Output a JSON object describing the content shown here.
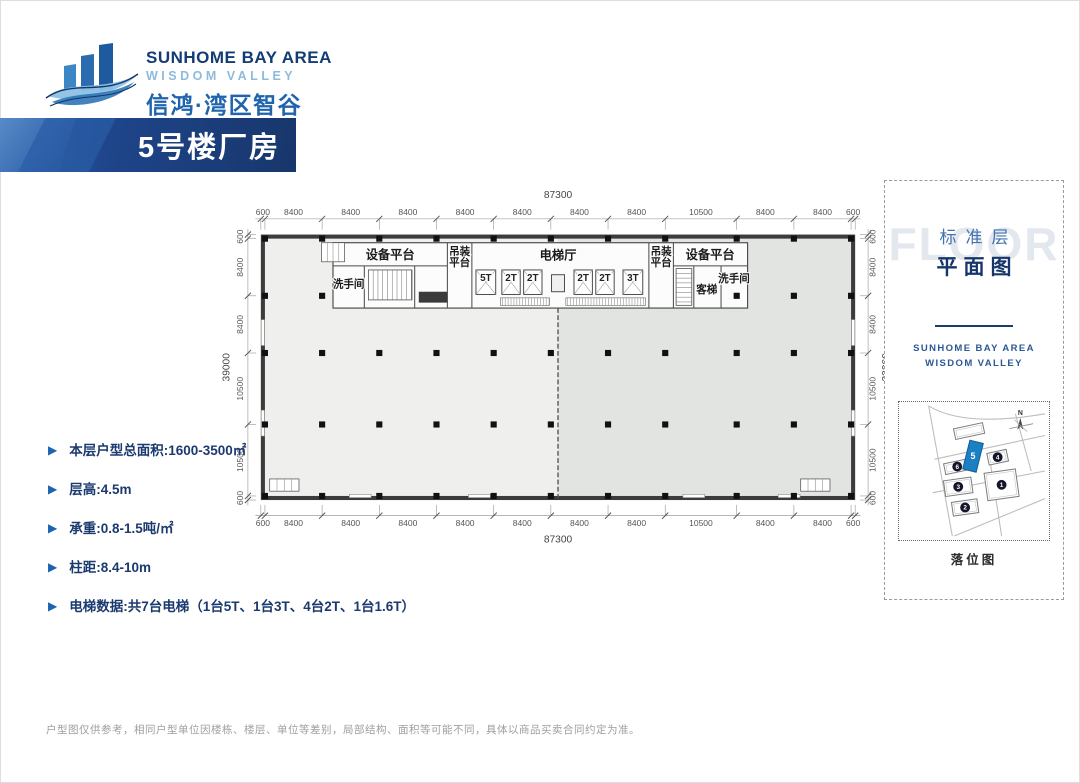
{
  "logo": {
    "line1": "SUNHOME BAY AREA",
    "line2": "WISDOM VALLEY",
    "line3": "信鸿·湾区智谷"
  },
  "banner": {
    "title": "5号楼厂房"
  },
  "specs": [
    "本层户型总面积:1600-3500㎡",
    "层高:4.5m",
    "承重:0.8-1.5吨/㎡",
    "柱距:8.4-10m",
    "电梯数据:共7台电梯（1台5T、1台3T、4台2T、1台1.6T）"
  ],
  "plan": {
    "total_width_label": "87300",
    "total_height_label": "39000",
    "h_segments": [
      600,
      8400,
      8400,
      8400,
      8400,
      8400,
      8400,
      8400,
      10500,
      8400,
      8400,
      600
    ],
    "v_segments": [
      600,
      8400,
      8400,
      10500,
      10500,
      600
    ],
    "partial_row_y": 9000,
    "partial_row_xs": [
      600,
      9000,
      69900,
      78300,
      86700
    ],
    "unit_fill_left": "#efefee",
    "unit_fill_right": "#e2e4e1",
    "core": {
      "x1": 10600,
      "x2": 71500,
      "y1": 1200,
      "y2": 10800
    },
    "core_walls_v": [
      [
        27400,
        1200,
        10800
      ],
      [
        31000,
        1200,
        10800
      ],
      [
        57000,
        1200,
        10800
      ],
      [
        60600,
        1200,
        10800
      ],
      [
        15200,
        4600,
        10800
      ],
      [
        22600,
        4600,
        10800
      ],
      [
        63600,
        4600,
        10800
      ],
      [
        67600,
        4600,
        10800
      ]
    ],
    "core_walls_h": [
      [
        10600,
        27400,
        4600
      ],
      [
        60600,
        71500,
        4600
      ]
    ],
    "room_labels": [
      {
        "t": "设备平台",
        "x": 19000,
        "y": 3600,
        "fs": 1800
      },
      {
        "t": "设备平台",
        "x": 66000,
        "y": 3600,
        "fs": 1800
      },
      {
        "t": "吊装",
        "x": 29200,
        "y": 3000,
        "fs": 1550
      },
      {
        "t": "平台",
        "x": 29200,
        "y": 4650,
        "fs": 1550
      },
      {
        "t": "吊装",
        "x": 58800,
        "y": 3000,
        "fs": 1550
      },
      {
        "t": "平台",
        "x": 58800,
        "y": 4650,
        "fs": 1550
      },
      {
        "t": "电梯厅",
        "x": 43650,
        "y": 3700,
        "fs": 1800
      },
      {
        "t": "洗手间",
        "x": 12900,
        "y": 7800,
        "fs": 1550
      },
      {
        "t": "洗手间",
        "x": 69500,
        "y": 7000,
        "fs": 1550
      },
      {
        "t": "客梯",
        "x": 65500,
        "y": 8600,
        "fs": 1550
      }
    ],
    "elevators": [
      {
        "label": "5T",
        "x": 31600,
        "w": 2900
      },
      {
        "label": "2T",
        "x": 35400,
        "w": 2700
      },
      {
        "label": "2T",
        "x": 38600,
        "w": 2700
      },
      {
        "label": "",
        "x": 42700,
        "w": 1900
      },
      {
        "label": "2T",
        "x": 46000,
        "w": 2700
      },
      {
        "label": "2T",
        "x": 49200,
        "w": 2700
      },
      {
        "label": "3T",
        "x": 53200,
        "w": 2900
      }
    ],
    "elevator_y": 5200,
    "elevator_h": 3600,
    "louvers": [
      {
        "x": 35200,
        "w": 7200
      },
      {
        "x": 44800,
        "w": 11700
      }
    ],
    "stairs": [
      {
        "x": 15800,
        "y": 5200,
        "w": 6400,
        "h": 4400,
        "dir": "v"
      },
      {
        "x": 61000,
        "y": 5000,
        "w": 2300,
        "h": 5400,
        "dir": "h"
      }
    ],
    "dark_rect": {
      "x": 23200,
      "y": 8400,
      "w": 4200,
      "h": 1600
    },
    "corner_features": [
      {
        "x": 1300,
        "y": 35900,
        "w": 4300,
        "h": 1800
      },
      {
        "x": 79300,
        "y": 35900,
        "w": 4300,
        "h": 1800
      },
      {
        "x": 8900,
        "y": 1200,
        "w": 3400,
        "h": 2800
      }
    ],
    "side_openings": [
      {
        "x": 60,
        "y": 12500,
        "w": 480,
        "h": 3800
      },
      {
        "x": 60,
        "y": 25800,
        "w": 480,
        "h": 3800
      },
      {
        "x": 86760,
        "y": 12500,
        "w": 480,
        "h": 3800
      },
      {
        "x": 86760,
        "y": 25800,
        "w": 480,
        "h": 3800
      }
    ],
    "bottom_openings": [
      {
        "x": 13000,
        "y": 38160,
        "w": 3200,
        "h": 480
      },
      {
        "x": 30500,
        "y": 38160,
        "w": 3200,
        "h": 480
      },
      {
        "x": 62000,
        "y": 38160,
        "w": 3200,
        "h": 480
      },
      {
        "x": 76000,
        "y": 38160,
        "w": 3200,
        "h": 480
      }
    ],
    "divider_x": 43650
  },
  "side_panel": {
    "watermark": "FLOOR",
    "title_top": "标准层",
    "title_bottom": "平面图",
    "brand1": "SUNHOME BAY AREA",
    "brand2": "WISDOM VALLEY",
    "map_caption": "落位图"
  },
  "map": {
    "compass_label": "N",
    "roads": [
      "M30,4 L54,136",
      "M30,4 Q66,26 148,12",
      "M36,58 L148,34",
      "M34,92 L148,70",
      "M56,136 L148,98",
      "M92,58 L104,136",
      "M118,12 L134,70"
    ],
    "buildings": [
      {
        "n": "",
        "x": 56,
        "y": 24,
        "w": 30,
        "h": 11,
        "r": -12
      },
      {
        "n": "6",
        "x": 46,
        "y": 60,
        "w": 26,
        "h": 11,
        "r": -12
      },
      {
        "n": "4",
        "x": 90,
        "y": 50,
        "w": 20,
        "h": 12,
        "r": -12
      },
      {
        "n": "3",
        "x": 46,
        "y": 78,
        "w": 28,
        "h": 16,
        "r": -8
      },
      {
        "n": "1",
        "x": 88,
        "y": 70,
        "w": 32,
        "h": 28,
        "r": -8
      },
      {
        "n": "2",
        "x": 54,
        "y": 100,
        "w": 26,
        "h": 14,
        "r": -8
      }
    ],
    "highlight": {
      "n": "5",
      "x": 68,
      "y": 40,
      "w": 14,
      "h": 30,
      "r": 14,
      "color": "#1b7fc4"
    }
  },
  "footer": {
    "disclaimer": "户型图仅供参考，相同户型单位因楼栋、楼层、单位等差别，局部结构、面积等可能不同，具体以商品买卖合同约定为准。"
  },
  "colors": {
    "navy": "#16356b",
    "blue": "#1f64ad",
    "dim": "#555555",
    "line": "#3c3c3c"
  }
}
